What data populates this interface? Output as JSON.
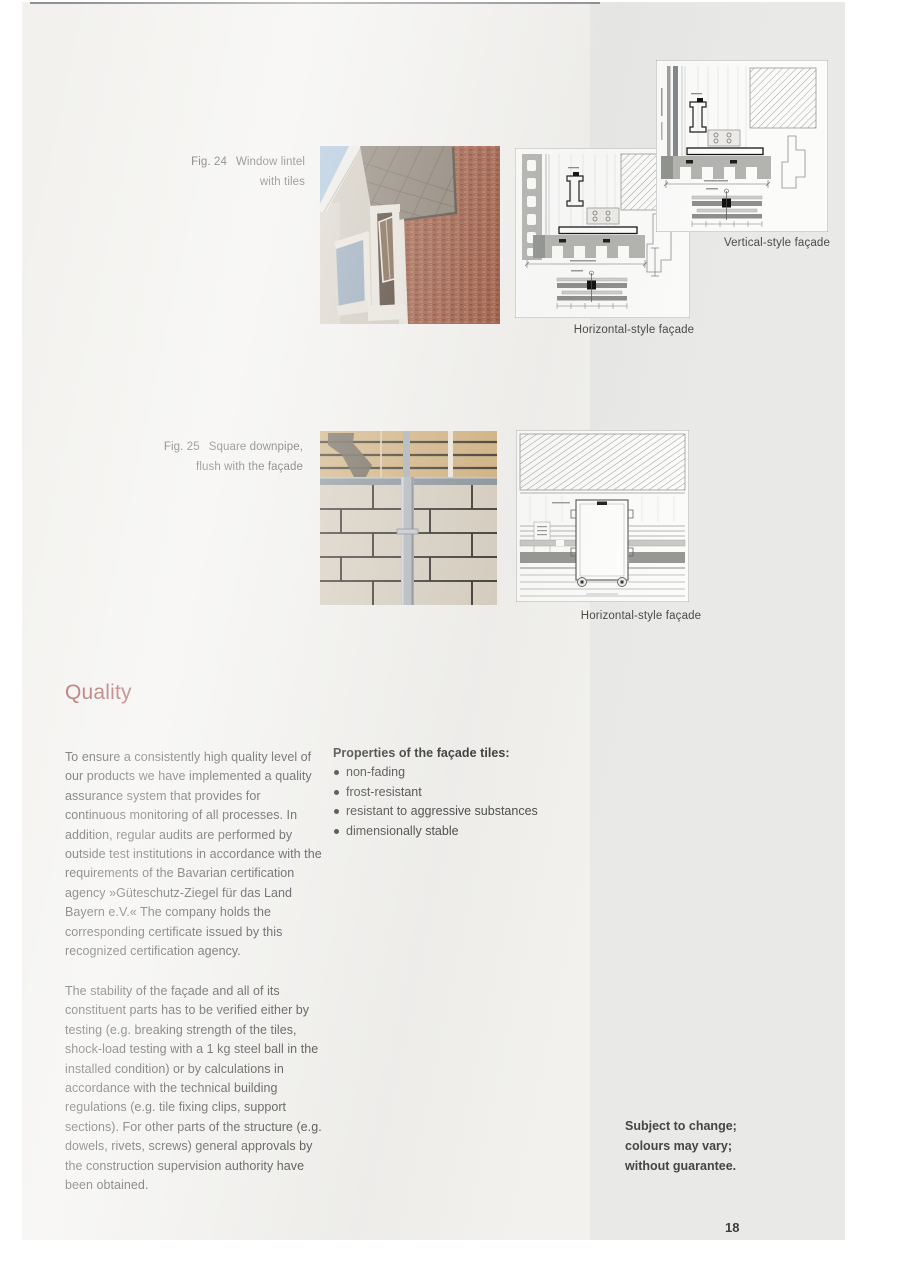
{
  "document": {
    "page_number": "18",
    "disclaimer_lines": [
      "Subject to change;",
      "colours may vary;",
      "without guarantee."
    ]
  },
  "figures": {
    "fig24": {
      "id": "Fig. 24",
      "caption_line1": "Window lintel",
      "caption_line2": "with tiles"
    },
    "fig25": {
      "id": "Fig. 25",
      "caption_line1": "Square downpipe,",
      "caption_line2": "flush with the façade"
    }
  },
  "diagrams": {
    "vertical_top_caption": "Vertical-style façade",
    "horizontal_top_caption": "Horizontal-style façade",
    "horizontal_bottom_caption": "Horizontal-style façade"
  },
  "quality_section": {
    "heading": "Quality",
    "paragraphs": [
      "To ensure a consistently high quality level of our products we have implemented a quality assurance system that provides for continuous monitoring of all processes. In addition, regular audits are performed by outside test institutions in accordance with the requirements of the Bavarian certification agency »Güteschutz-Ziegel für das Land Bayern e.V.« The company holds the corresponding certificate issued by this recognized certification agency.",
      "The stability of the façade and all of its constituent parts has to be verified either by testing (e.g. breaking strength of the tiles, shock-load testing with a 1 kg steel ball in the installed condition) or by calculations in accordance with the technical building regulations (e.g. tile fixing clips, support sections). For other parts of the structure (e.g. dowels, rivets, screws) general approvals by the construction supervision authority have been obtained."
    ]
  },
  "properties_section": {
    "heading": "Properties of the façade tiles:",
    "bullets": [
      "non-fading",
      "frost-resistant",
      "resistant to aggressive substances",
      "dimensionally stable"
    ]
  },
  "colors": {
    "heading_red": "#a35552",
    "body_text": "#4e4e4e",
    "page_left_bg": "#f2f1ee",
    "page_right_bg": "#e9e9e7",
    "paper_white": "#fbfbfa"
  }
}
